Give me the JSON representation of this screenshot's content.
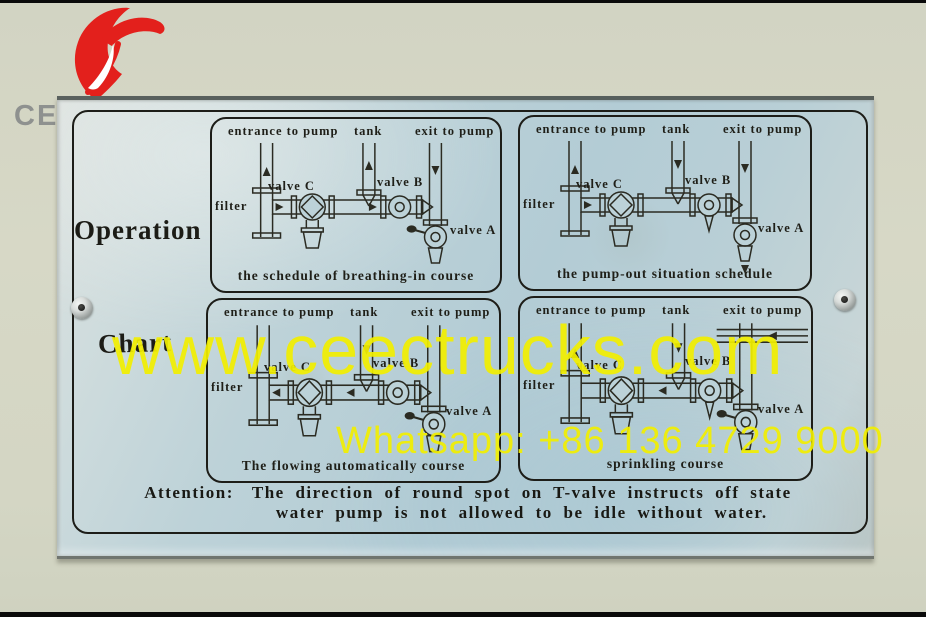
{
  "colors": {
    "accent_red": "#e3201c",
    "watermark_yellow": "#f2ef00",
    "plate_blue": "#b7cfd6",
    "wall_green": "#d5d7c5",
    "ink": "#1d1d18",
    "brand_gray": "#8b8e8d"
  },
  "watermarks": {
    "brand": "CEEC TRUCKS",
    "site": "www.ceectrucks.com",
    "whatsapp": "Whatsapp: +86 136 4729 9000"
  },
  "plate": {
    "side_label_line1": "Operation",
    "side_label_line2": "Chart",
    "panel_labels": {
      "entrance": "entrance to pump",
      "tank": "tank",
      "exit": "exit to pump",
      "valve_c": "valve C",
      "valve_b": "valve B",
      "valve_a": "valve A",
      "filter": "filter"
    },
    "panels": [
      {
        "id": "breathing-in",
        "caption": "the schedule of breathing-in course"
      },
      {
        "id": "pump-out",
        "caption": "the pump-out situation schedule"
      },
      {
        "id": "flowing-auto",
        "caption": "The flowing automatically course"
      },
      {
        "id": "sprinkling",
        "caption": "sprinkling course"
      }
    ],
    "attention": {
      "label": "Attention:",
      "line1": "The direction of round spot on T-valve instructs off state",
      "line2": "water pump is not allowed to be idle without water."
    }
  }
}
